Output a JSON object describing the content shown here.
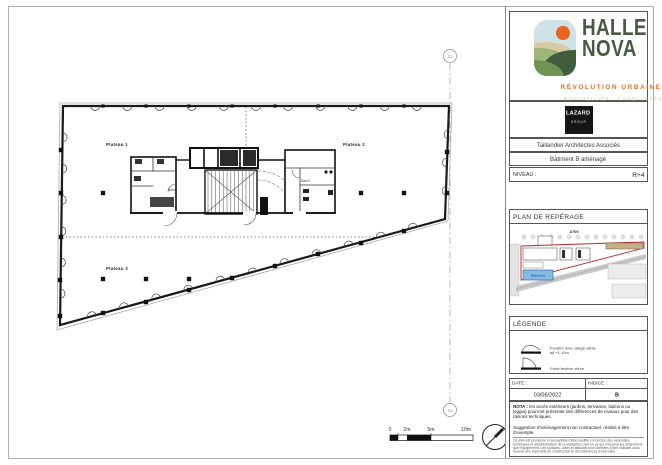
{
  "sheet": {
    "plan": {
      "plateau1": "Plateau 1",
      "plateau2": "Plateau 2",
      "plateau3": "Plateau 3",
      "san_f": "San.F",
      "san_h": "San.H",
      "grid_marker": "11",
      "scale_ticks": [
        "0",
        "2m",
        "5m",
        "10m"
      ]
    },
    "titleblock": {
      "brand": {
        "line1": "HALLE",
        "line2": "NOVA",
        "tagline": "RÉVOLUTION URBAINE",
        "location": "MONTPELLIER - CAMBACÉRÈS"
      },
      "lazard": {
        "name": "LAZARD",
        "sub": "GROUP"
      },
      "architect": "Taillandier Architectes Associés",
      "project": "Bâtiment B aménagé",
      "niveau": {
        "label": "NIVEAU :",
        "value": "R+4"
      },
      "reperage": {
        "title": "PLAN DE REPÉRAGE",
        "highway": "A709",
        "batiment": "Bâtiment B"
      },
      "legende": {
        "title": "LÉGENDE",
        "item1_line1": "Fenêtre avec allège vitrée",
        "item1_line2": "alt +1.10m",
        "item2": "Porte fenêtre vitrée"
      },
      "stamp": {
        "date_label": "DATE :",
        "date_value": "03/06/2022",
        "indice_label": "INDICE :",
        "indice_value": "B"
      },
      "nota": {
        "bold": "NOTA :",
        "text1": "les accès extérieurs (jardins, terrasses, balcons ou loggia) pourront présenter des différences de niveaux pour des raisons techniques.",
        "text2": "Suggestion d'aménagement non contractuel, réalisé à titre d'exemple.",
        "fine_print": "Ce plan est provisoire et susceptible d'être modifié en fonction des nécessités techniques et administratives de la réalisation, tant en ce qui concerne les dimensions que l'équipement. Les surfaces, cotes et altitudes sont données à titre indicatif, sous réserve des impératifs de construction et des tolérances d'exécution."
      }
    },
    "colors": {
      "accent_orange": "#e2702a",
      "brand_green": "#4a5a42",
      "site_outline_red": "#c42222",
      "batiment_blue": "#85b9e6"
    }
  }
}
